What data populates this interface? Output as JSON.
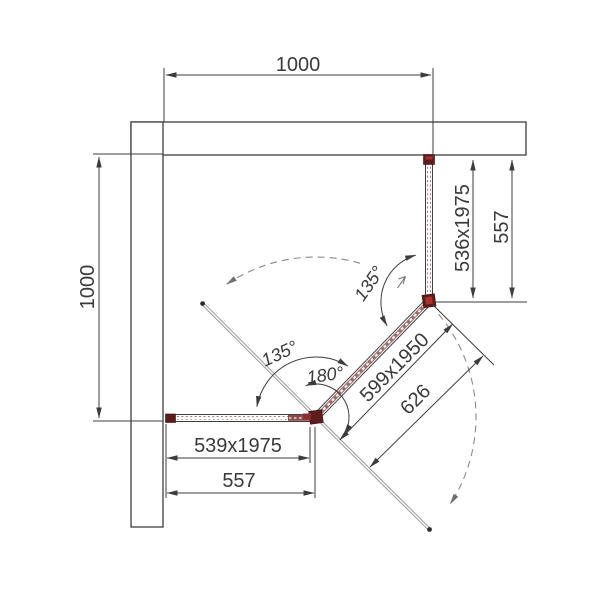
{
  "drawing": {
    "dims": {
      "top_width": "1000",
      "left_height": "1000",
      "right_panel": "536x1975",
      "right_offset": "557",
      "door_panel": "599x1950",
      "door_offset": "626",
      "bottom_panel": "539x1975",
      "bottom_offset": "557"
    },
    "angles": {
      "top": "135°",
      "bottom": "135°",
      "door_swing": "180°"
    },
    "colors": {
      "line": "#3c3c3c",
      "profile_red": "#9b6e6e",
      "hinge_red": "#5e1d1d",
      "swing_dash": "#8a8a8a"
    }
  }
}
